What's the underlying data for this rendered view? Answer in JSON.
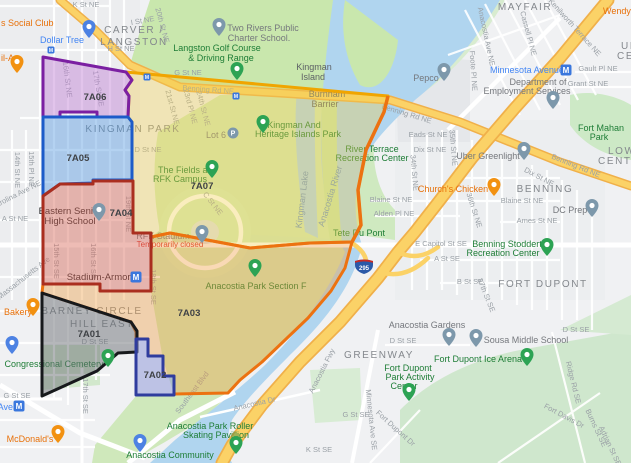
{
  "theme": {
    "water": "#b0d5ef",
    "land": "#f0f1f3",
    "urban": "#e7e9ec",
    "park": "#cfe8bb",
    "park_bright": "#c9e7ad",
    "road_major_fill": "#fbd267",
    "road_major_casing": "#f0b04a",
    "metro_blue": "#3a77dd",
    "shield_blue": "#2b59a8",
    "shield_red": "#cb2a22"
  },
  "districts": [
    {
      "id": "7A07",
      "label": "7A07",
      "fill": "#f2cc4a",
      "fill_opacity": 0.36,
      "stroke": "#f0a500",
      "x": 202,
      "y": 189
    },
    {
      "id": "7A03",
      "label": "7A03",
      "fill": "#f09c3c",
      "fill_opacity": 0.38,
      "stroke": "#ec7211",
      "x": 189,
      "y": 316
    },
    {
      "id": "7A06",
      "label": "7A06",
      "fill": "#c07fd4",
      "fill_opacity": 0.45,
      "stroke": "#7b1fa2",
      "x": 95,
      "y": 100
    },
    {
      "id": "7A05",
      "label": "7A05",
      "fill": "#4f97e0",
      "fill_opacity": 0.42,
      "stroke": "#1c5bc9",
      "x": 78,
      "y": 161
    },
    {
      "id": "7A04",
      "label": "7A04",
      "fill": "#d96a5a",
      "fill_opacity": 0.45,
      "stroke": "#aa2e1f",
      "x": 121,
      "y": 216
    },
    {
      "id": "7A01",
      "label": "7A01",
      "fill": "#6b7075",
      "fill_opacity": 0.5,
      "stroke": "#17191c",
      "x": 89,
      "y": 337
    },
    {
      "id": "7A02",
      "label": "7A02",
      "fill": "#8a93d8",
      "fill_opacity": 0.5,
      "stroke": "#2f3c9e",
      "x": 155,
      "y": 378
    }
  ],
  "labels": {
    "neighborhoods": [
      {
        "t": "CARVER /",
        "x": 134,
        "y": 33
      },
      {
        "t": "LANGSTON",
        "x": 134,
        "y": 45
      },
      {
        "t": "KINGMAN PARK",
        "x": 133,
        "y": 132
      },
      {
        "t": "MAYFAIR",
        "x": 525,
        "y": 10
      },
      {
        "t": "BENNING",
        "x": 545,
        "y": 192
      },
      {
        "t": "FORT DUPONT",
        "x": 543,
        "y": 287
      },
      {
        "t": "GREENWAY",
        "x": 379,
        "y": 358
      },
      {
        "t": "BARNEY CIRCLE",
        "x": 92,
        "y": 314
      },
      {
        "t": "HILL EAST",
        "x": 102,
        "y": 327
      },
      {
        "t": "UPPER",
        "x": 621,
        "y": 49,
        "a": "s"
      },
      {
        "t": "CENTRAL",
        "x": 617,
        "y": 59,
        "a": "s"
      },
      {
        "t": "LOWER",
        "x": 608,
        "y": 154,
        "a": "s"
      },
      {
        "t": "CENTRAL",
        "x": 598,
        "y": 164,
        "a": "s"
      }
    ],
    "streets": [
      {
        "t": "K St NE",
        "x": 86,
        "y": 7
      },
      {
        "t": "I St NE",
        "x": 143,
        "y": 23,
        "r": -10
      },
      {
        "t": "H St NE",
        "x": 121,
        "y": 51
      },
      {
        "t": "G St NE",
        "x": 188,
        "y": 75
      },
      {
        "t": "20th St NE",
        "x": 160,
        "y": 26,
        "r": 75
      },
      {
        "t": "16th St NE",
        "x": 65,
        "y": 80,
        "r": 83
      },
      {
        "t": "17th St NE",
        "x": 96,
        "y": 89,
        "r": 80
      },
      {
        "t": "14th St NE",
        "x": 15,
        "y": 170,
        "r": 90
      },
      {
        "t": "15th Pl NE",
        "x": 29,
        "y": 169,
        "r": 90
      },
      {
        "t": "Carolina Ave NE",
        "x": 17,
        "y": 197,
        "r": -27
      },
      {
        "t": "A St NE",
        "x": 15,
        "y": 221
      },
      {
        "t": "Massachusetts Ave",
        "x": 25,
        "y": 280,
        "r": -38
      },
      {
        "t": "19th St NE",
        "x": 126,
        "y": 214,
        "r": 90
      },
      {
        "t": "15th St SE",
        "x": 54,
        "y": 261,
        "r": 90
      },
      {
        "t": "16th St SE",
        "x": 91,
        "y": 261,
        "r": 90
      },
      {
        "t": "18th St SE",
        "x": 151,
        "y": 287,
        "r": 90
      },
      {
        "t": "17th St SE",
        "x": 83,
        "y": 396,
        "r": 90
      },
      {
        "t": "D St SE",
        "x": 95,
        "y": 344
      },
      {
        "t": "G St SE",
        "x": 17,
        "y": 398
      },
      {
        "t": "D St NE",
        "x": 148,
        "y": 152
      },
      {
        "t": "C St NE",
        "x": 211,
        "y": 205,
        "r": 52
      },
      {
        "t": "21st St NE",
        "x": 170,
        "y": 108,
        "r": 75
      },
      {
        "t": "23rd Pl NE",
        "x": 188,
        "y": 107,
        "r": 75
      },
      {
        "t": "24th St NE",
        "x": 201,
        "y": 109,
        "r": 75
      },
      {
        "t": "Benning Rd NE",
        "x": 208,
        "y": 92,
        "r": 4
      },
      {
        "t": "Benning Rd NE",
        "x": 406,
        "y": 116,
        "r": 17
      },
      {
        "t": "Benning Rd NE",
        "x": 575,
        "y": 168,
        "r": 22
      },
      {
        "t": "Anacostia Ave NE",
        "x": 484,
        "y": 37,
        "r": 78
      },
      {
        "t": "Foote Pl NE",
        "x": 471,
        "y": 71,
        "r": 86
      },
      {
        "t": "Cassell Pl NE",
        "x": 526,
        "y": 34,
        "r": 75
      },
      {
        "t": "Kenilworth Terrace NE",
        "x": 573,
        "y": 29,
        "r": 48
      },
      {
        "t": "Gault Pl NE",
        "x": 598,
        "y": 71
      },
      {
        "t": "Grant St NE",
        "x": 588,
        "y": 86
      },
      {
        "t": "Eads St NE",
        "x": 428,
        "y": 137
      },
      {
        "t": "Dix St NE",
        "x": 430,
        "y": 152
      },
      {
        "t": "Dix St NE",
        "x": 538,
        "y": 179,
        "r": 28
      },
      {
        "t": "35th St NE",
        "x": 451,
        "y": 148,
        "r": 85
      },
      {
        "t": "34th St NE",
        "x": 412,
        "y": 173,
        "r": 85
      },
      {
        "t": "36th St NE",
        "x": 472,
        "y": 211,
        "r": 72
      },
      {
        "t": "Blaine St NE",
        "x": 391,
        "y": 202
      },
      {
        "t": "Blaine St NE",
        "x": 522,
        "y": 203
      },
      {
        "t": "Alden Pl NE",
        "x": 394,
        "y": 216
      },
      {
        "t": "Ames St NE",
        "x": 537,
        "y": 223
      },
      {
        "t": "E Capitol St SE",
        "x": 441,
        "y": 246
      },
      {
        "t": "A St SE",
        "x": 447,
        "y": 261
      },
      {
        "t": "B St SE",
        "x": 470,
        "y": 284
      },
      {
        "t": "37th St SE",
        "x": 484,
        "y": 296,
        "r": 68
      },
      {
        "t": "D St SE",
        "x": 576,
        "y": 332
      },
      {
        "t": "D St SE",
        "x": 403,
        "y": 343
      },
      {
        "t": "Ridge Rd SE",
        "x": 571,
        "y": 383,
        "r": 76
      },
      {
        "t": "Fort Davis Dr",
        "x": 563,
        "y": 418,
        "r": 28
      },
      {
        "t": "Burns St SE",
        "x": 594,
        "y": 429,
        "r": 65
      },
      {
        "t": "Adrian St SE",
        "x": 608,
        "y": 447,
        "r": 65
      },
      {
        "t": "Fort Dupont Dr",
        "x": 394,
        "y": 430,
        "r": 42
      },
      {
        "t": "Minnesota Ave SE",
        "x": 369,
        "y": 420,
        "r": 84
      },
      {
        "t": "G St SE",
        "x": 356,
        "y": 417
      },
      {
        "t": "K St SE",
        "x": 319,
        "y": 452
      },
      {
        "t": "Anacostia Dr",
        "x": 255,
        "y": 406,
        "r": -13
      },
      {
        "t": "Southeast Blvd",
        "x": 194,
        "y": 394,
        "r": -53
      },
      {
        "t": "Anacostia Fwy",
        "x": 324,
        "y": 372,
        "r": -63
      }
    ],
    "water": [
      {
        "t": "Anacostia River",
        "x": 333,
        "y": 197,
        "r": -73
      },
      {
        "t": "Kingman Lake",
        "x": 305,
        "y": 200,
        "r": -83
      }
    ],
    "pois": [
      {
        "t": "s Social Club",
        "x": 1,
        "y": 26,
        "c": "orange",
        "a": "s"
      },
      {
        "t": "Dollar Tree",
        "x": 62,
        "y": 43,
        "c": "blue"
      },
      {
        "t": "il-A",
        "x": 1,
        "y": 61,
        "c": "orange",
        "a": "s"
      },
      {
        "t": "Two Rivers Public",
        "x": 263,
        "y": 31,
        "c": "gray"
      },
      {
        "t": "Charter School.",
        "x": 259,
        "y": 41,
        "c": "gray"
      },
      {
        "t": "Langston Golf Course",
        "x": 217,
        "y": 51,
        "c": "green"
      },
      {
        "t": "& Driving Range",
        "x": 221,
        "y": 61,
        "c": "green"
      },
      {
        "t": "Kingman",
        "x": 314,
        "y": 70,
        "c": "grayDark"
      },
      {
        "t": "Island",
        "x": 313,
        "y": 80,
        "c": "grayDark"
      },
      {
        "t": "Burnham",
        "x": 327,
        "y": 97,
        "c": "grayDark"
      },
      {
        "t": "Barrier",
        "x": 325,
        "y": 107,
        "c": "grayDark"
      },
      {
        "t": "Wendy's",
        "x": 603,
        "y": 14,
        "c": "orange",
        "a": "s"
      },
      {
        "t": "Minnesota Avenue",
        "x": 527,
        "y": 73,
        "c": "blue"
      },
      {
        "t": "Pepco",
        "x": 426,
        "y": 81,
        "c": "gray"
      },
      {
        "t": "Department of",
        "x": 538,
        "y": 85,
        "c": "gray"
      },
      {
        "t": "Employment Services",
        "x": 527,
        "y": 94,
        "c": "gray"
      },
      {
        "t": "Fort Mahan",
        "x": 601,
        "y": 131,
        "c": "green"
      },
      {
        "t": "Park",
        "x": 599,
        "y": 140,
        "c": "green"
      },
      {
        "t": "Uber Greenlight",
        "x": 488,
        "y": 159,
        "c": "gray"
      },
      {
        "t": "River Terrace",
        "x": 372,
        "y": 152,
        "c": "green"
      },
      {
        "t": "Recreation Center",
        "x": 372,
        "y": 161,
        "c": "green"
      },
      {
        "t": "Church's Chicken",
        "x": 453,
        "y": 192,
        "c": "orange"
      },
      {
        "t": "DC Prep",
        "x": 570,
        "y": 213,
        "c": "gray"
      },
      {
        "t": "Lot 6",
        "x": 216,
        "y": 138,
        "c": "gray"
      },
      {
        "t": "Kingman And",
        "x": 294,
        "y": 128,
        "c": "green"
      },
      {
        "t": "Heritage Islands Park",
        "x": 298,
        "y": 137,
        "c": "green"
      },
      {
        "t": "The Fields at",
        "x": 184,
        "y": 173,
        "c": "green"
      },
      {
        "t": "RFK Campus",
        "x": 180,
        "y": 182,
        "c": "green"
      },
      {
        "t": "Eastern Senior",
        "x": 70,
        "y": 214,
        "c": "black"
      },
      {
        "t": "High School",
        "x": 70,
        "y": 224,
        "c": "black"
      },
      {
        "t": "RFK Stadium",
        "x": 163,
        "y": 239,
        "c": "gray"
      },
      {
        "t": "Temporarily closed",
        "x": 170,
        "y": 247,
        "c": "red"
      },
      {
        "t": "Stadium-Armory",
        "x": 101,
        "y": 280,
        "c": "black"
      },
      {
        "t": "Tete Du Pont",
        "x": 359,
        "y": 236,
        "c": "green"
      },
      {
        "t": "Benning Stoddert",
        "x": 507,
        "y": 247,
        "c": "green"
      },
      {
        "t": "Recreation Center",
        "x": 503,
        "y": 256,
        "c": "green"
      },
      {
        "t": "Anacostia Park Section F",
        "x": 256,
        "y": 289,
        "c": "green"
      },
      {
        "t": "Anacostia Gardens",
        "x": 427,
        "y": 328,
        "c": "gray"
      },
      {
        "t": "Sousa Middle School",
        "x": 526,
        "y": 343,
        "c": "gray"
      },
      {
        "t": "Fort Dupont Ice Arena",
        "x": 478,
        "y": 362,
        "c": "green"
      },
      {
        "t": "Fort Dupont",
        "x": 408,
        "y": 371,
        "c": "green"
      },
      {
        "t": "Park Activity",
        "x": 410,
        "y": 380,
        "c": "green"
      },
      {
        "t": "Center",
        "x": 404,
        "y": 389,
        "c": "green"
      },
      {
        "t": "Anacostia Park Roller",
        "x": 210,
        "y": 429,
        "c": "green"
      },
      {
        "t": "Skating Pavillion",
        "x": 216,
        "y": 438,
        "c": "green"
      },
      {
        "t": "Anacostia Community",
        "x": 170,
        "y": 458,
        "c": "green"
      },
      {
        "t": "Congressional Cemetery",
        "x": 54,
        "y": 367,
        "c": "green"
      },
      {
        "t": "McDonald's",
        "x": 30,
        "y": 442,
        "c": "orange"
      },
      {
        "t": "Ave",
        "x": 13,
        "y": 410,
        "c": "blue",
        "a": "e"
      },
      {
        "t": "Bakery",
        "x": 4,
        "y": 315,
        "c": "orange",
        "a": "s"
      }
    ]
  },
  "markers": [
    {
      "n": "dollar-tree-marker",
      "k": "pin",
      "c": "blue",
      "x": 89,
      "y": 38
    },
    {
      "n": "restaurant-marker",
      "k": "pin",
      "c": "orange",
      "x": 17,
      "y": 73
    },
    {
      "n": "bakery-marker",
      "k": "pin",
      "c": "orange",
      "x": 33,
      "y": 316
    },
    {
      "n": "shopping-marker",
      "k": "pin",
      "c": "blue",
      "x": 12,
      "y": 354
    },
    {
      "n": "mcdonalds-marker",
      "k": "pin",
      "c": "orange",
      "x": 58,
      "y": 443
    },
    {
      "n": "cemetery-marker",
      "k": "pin",
      "c": "green",
      "x": 108,
      "y": 367
    },
    {
      "n": "eastern-hs-school-marker",
      "k": "pin",
      "c": "gray",
      "x": 99,
      "y": 221
    },
    {
      "n": "two-rivers-school-marker",
      "k": "pin",
      "c": "gray",
      "x": 219,
      "y": 36
    },
    {
      "n": "golf-marker",
      "k": "pin",
      "c": "green",
      "x": 237,
      "y": 80
    },
    {
      "n": "heritage-park-marker",
      "k": "pin",
      "c": "green",
      "x": 263,
      "y": 133
    },
    {
      "n": "lot6-parking-marker",
      "k": "parking",
      "x": 233,
      "y": 133
    },
    {
      "n": "fields-rfk-marker",
      "k": "pin",
      "c": "green",
      "x": 212,
      "y": 178
    },
    {
      "n": "rfk-stadium-marker",
      "k": "pin",
      "c": "gray",
      "x": 202,
      "y": 243
    },
    {
      "n": "section-f-marker",
      "k": "pin",
      "c": "green",
      "x": 255,
      "y": 277
    },
    {
      "n": "pepco-marker",
      "k": "pin",
      "c": "gray",
      "x": 444,
      "y": 81
    },
    {
      "n": "employment-services-marker",
      "k": "pin",
      "c": "gray",
      "x": 553,
      "y": 109
    },
    {
      "n": "uber-greenlight-marker",
      "k": "pin",
      "c": "gray",
      "x": 524,
      "y": 160
    },
    {
      "n": "churchs-chicken-marker",
      "k": "pin",
      "c": "orange",
      "x": 494,
      "y": 196
    },
    {
      "n": "dc-prep-marker",
      "k": "pin",
      "c": "gray",
      "x": 592,
      "y": 217
    },
    {
      "n": "benning-stoddert-marker",
      "k": "pin",
      "c": "green",
      "x": 547,
      "y": 256
    },
    {
      "n": "anacostia-gardens-marker",
      "k": "pin",
      "c": "gray",
      "x": 449,
      "y": 346
    },
    {
      "n": "sousa-school-marker",
      "k": "pin",
      "c": "gray",
      "x": 476,
      "y": 347
    },
    {
      "n": "ice-arena-marker",
      "k": "pin",
      "c": "green",
      "x": 527,
      "y": 366
    },
    {
      "n": "activity-center-marker",
      "k": "pin",
      "c": "green",
      "x": 409,
      "y": 401
    },
    {
      "n": "roller-skating-marker",
      "k": "pin",
      "c": "green",
      "x": 236,
      "y": 454
    },
    {
      "n": "boathouse-marker",
      "k": "pin",
      "c": "blue",
      "x": 140,
      "y": 452
    },
    {
      "n": "metro-minnesota-avenue-icon",
      "k": "metro",
      "x": 566,
      "y": 70
    },
    {
      "n": "metro-stadium-armory-icon",
      "k": "metro",
      "x": 136,
      "y": 277
    },
    {
      "n": "metro-potomac-ave-icon",
      "k": "metro",
      "x": 19,
      "y": 406
    },
    {
      "n": "streetcar-stop-icon",
      "k": "tsq",
      "x": 51,
      "y": 50
    },
    {
      "n": "streetcar-stop-icon",
      "k": "tsq",
      "x": 147,
      "y": 77
    },
    {
      "n": "streetcar-stop-icon",
      "k": "tsq",
      "x": 236,
      "y": 96
    },
    {
      "n": "route-shield-295",
      "k": "shield",
      "t": "295",
      "x": 364,
      "y": 266
    }
  ]
}
